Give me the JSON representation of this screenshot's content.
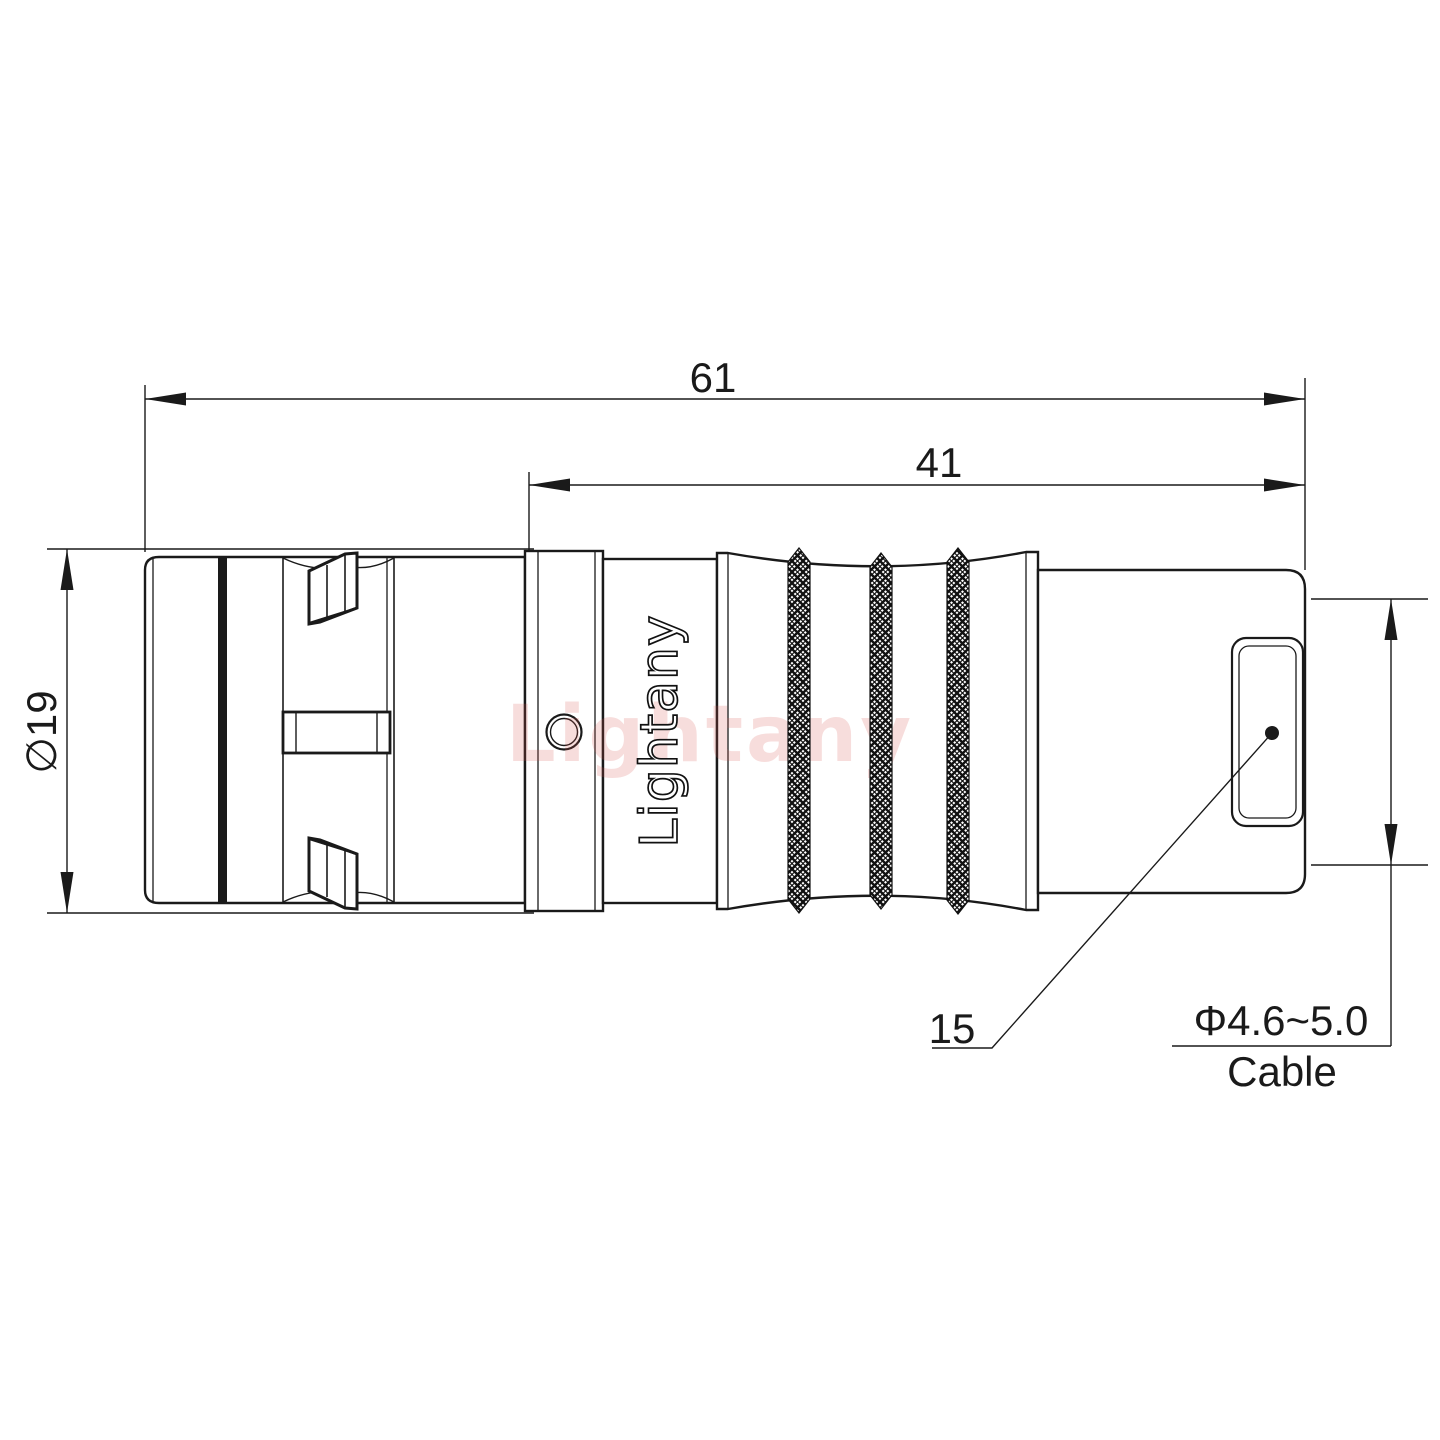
{
  "meta": {
    "drawing_type": "connector-technical-drawing",
    "background": "#ffffff",
    "line_color": "#1a1a1a",
    "watermark_color": "rgba(217,83,79,0.20)"
  },
  "labels": {
    "overall_length": "61",
    "rear_section_length": "41",
    "shell_diameter": "∅19",
    "part_ref": "15",
    "cable_diameter_range": "Φ4.6~5.0",
    "cable_word": "Cable"
  },
  "branding": {
    "engraved_logo": "Lightany",
    "watermark": "Lightany"
  }
}
